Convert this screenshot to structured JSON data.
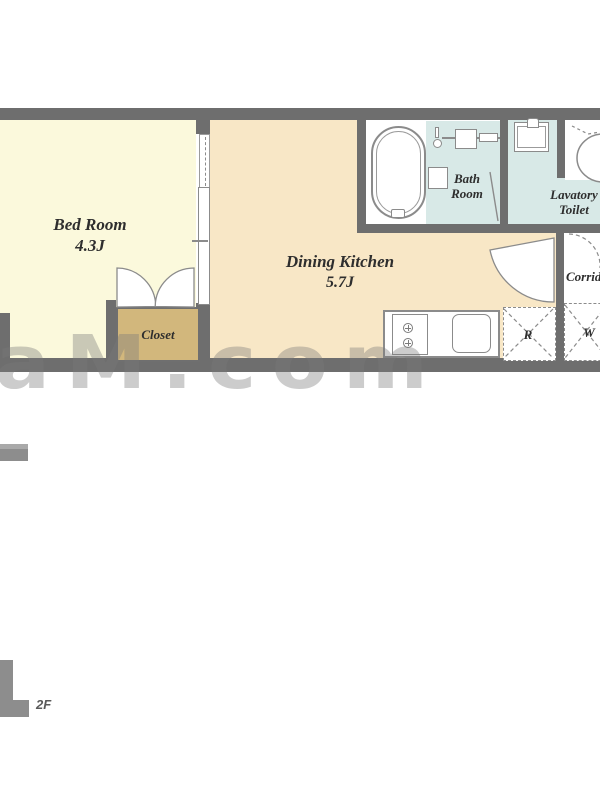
{
  "floorplan": {
    "floor_label": "2F",
    "watermark": "aM.com",
    "rooms": {
      "bedroom": {
        "name": "Bed Room",
        "size": "4.3J"
      },
      "dining_kitchen": {
        "name": "Dining Kitchen",
        "size": "5.7J"
      },
      "bathroom": {
        "name": "Bath\nRoom"
      },
      "lavatory_toilet": {
        "name": "Lavatory\nToilet"
      },
      "corridor": {
        "name": "Corridor"
      },
      "closet": {
        "name": "Closet"
      }
    },
    "appliance_marks": {
      "refrigerator": "R",
      "washer": "W"
    },
    "colors": {
      "wall": "#6e6e6e",
      "bedroom_floor": "#fbf9dc",
      "dining_floor": "#f8e7c6",
      "wet_area": "#d8e9e7",
      "closet": "#d2b77c",
      "outline": "#8b8b8b",
      "label_text": "#2e2e2e"
    }
  }
}
